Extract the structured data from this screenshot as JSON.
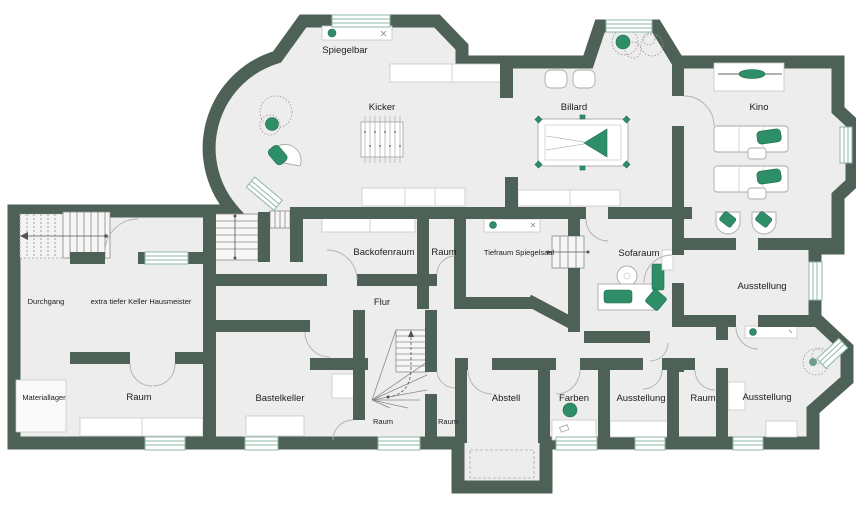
{
  "title": "Kellergeschoss Grundriss",
  "colors": {
    "wall": "#4e6156",
    "floor": "#ededed",
    "accent_green": "#2e8e67",
    "window_glazing": "#8db7a6",
    "label_text": "#1c1c1c"
  },
  "icons": {
    "plant-icon": "scribble-circle plant",
    "stairs-icon": "tread lines with direction arrow",
    "billard-table-icon": "rect with green triangle rack",
    "foosball-table-icon": "rect with rods",
    "sofa-icon": "rounded rect with green cushion",
    "armchair-icon": "round chair with green seat",
    "bar-counter-icon": "counter with green stool",
    "projector-icon": "green lens on line",
    "desk-icon": "desk with green chair"
  },
  "rooms": [
    {
      "id": "spiegelbar",
      "label": "Spiegelbar",
      "x": 345,
      "y": 50
    },
    {
      "id": "kicker",
      "label": "Kicker",
      "x": 382,
      "y": 107
    },
    {
      "id": "billard",
      "label": "Billard",
      "x": 574,
      "y": 107
    },
    {
      "id": "kino",
      "label": "Kino",
      "x": 759,
      "y": 107
    },
    {
      "id": "durchgang",
      "label": "Durchgang",
      "x": 46,
      "y": 301
    },
    {
      "id": "hausmeister",
      "label": "extra tiefer Keller Hausmeister",
      "x": 141,
      "y": 301
    },
    {
      "id": "backofenraum",
      "label": "Backofenraum",
      "x": 384,
      "y": 252
    },
    {
      "id": "raum-klein",
      "label": "Raum",
      "x": 444,
      "y": 252
    },
    {
      "id": "tiefraum",
      "label": "Tiefraum Spiegelsaal",
      "x": 519,
      "y": 252
    },
    {
      "id": "sofaraum",
      "label": "Sofaraum",
      "x": 639,
      "y": 253
    },
    {
      "id": "ausstellung-mitte",
      "label": "Ausstellung",
      "x": 762,
      "y": 286
    },
    {
      "id": "flur",
      "label": "Flur",
      "x": 382,
      "y": 302
    },
    {
      "id": "materiallager",
      "label": "Materiallager",
      "x": 44,
      "y": 397
    },
    {
      "id": "raum-gross",
      "label": "Raum",
      "x": 139,
      "y": 397
    },
    {
      "id": "bastelkeller",
      "label": "Bastelkeller",
      "x": 280,
      "y": 398
    },
    {
      "id": "raum-treppe",
      "label": "Raum",
      "x": 383,
      "y": 421
    },
    {
      "id": "raum-schmal",
      "label": "Raum",
      "x": 448,
      "y": 421
    },
    {
      "id": "abstell",
      "label": "Abstell",
      "x": 506,
      "y": 398
    },
    {
      "id": "farben",
      "label": "Farben",
      "x": 574,
      "y": 398
    },
    {
      "id": "ausstellung-sued",
      "label": "Ausstellung",
      "x": 641,
      "y": 398
    },
    {
      "id": "raum-sued",
      "label": "Raum",
      "x": 703,
      "y": 398
    },
    {
      "id": "ausstellung-ost",
      "label": "Ausstellung",
      "x": 767,
      "y": 397
    }
  ]
}
